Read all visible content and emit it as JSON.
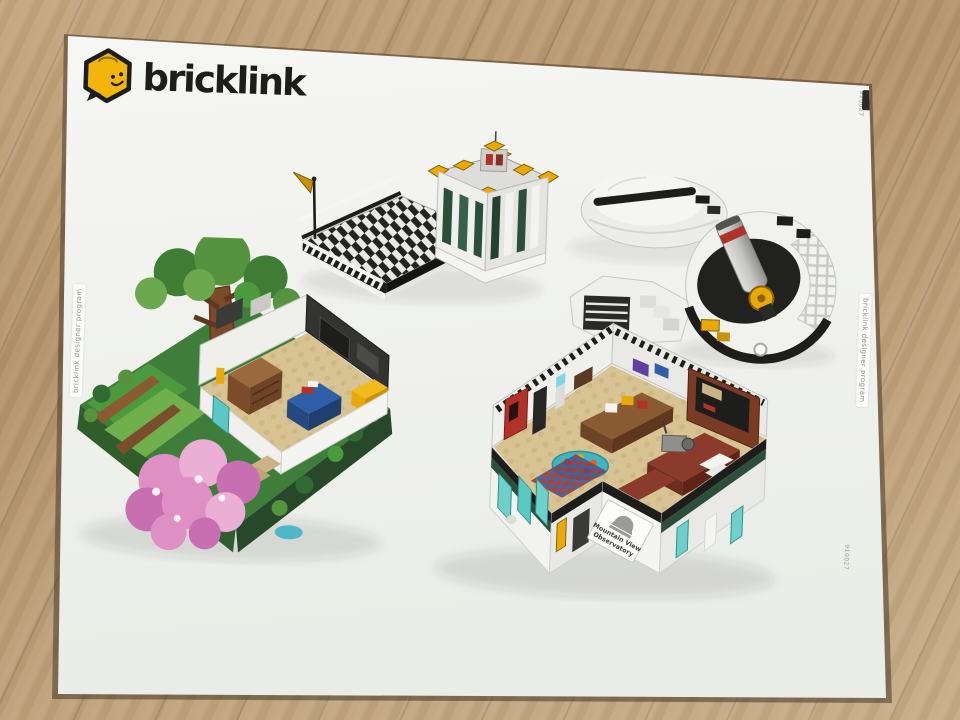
{
  "box": {
    "brand": "bricklink",
    "left_edge_label": "bricklink designer program",
    "right_edge_label": "bricklink designer program",
    "top_right_code": "910027",
    "bottom_right_code": "910027"
  },
  "sign": {
    "line1": "Mountain View",
    "line2": "Observatory"
  },
  "colors": {
    "brand_yellow": "#F2B50C",
    "logo_black": "#1D1D1B",
    "box_white": "#F2F2EF",
    "floor_wood": "#BD9F78",
    "accent_yellow": "#E9A90B",
    "dark_green": "#2C4F3B",
    "leaf_green": "#4C9A3E",
    "blossom_pink": "#DE8FC3",
    "baseplate_tan": "#D8C392",
    "teal_glass": "#5BC8C4",
    "vending_red": "#B03228",
    "reddish_brown": "#7B4B2A",
    "table_teal": "#3FB5C0"
  }
}
